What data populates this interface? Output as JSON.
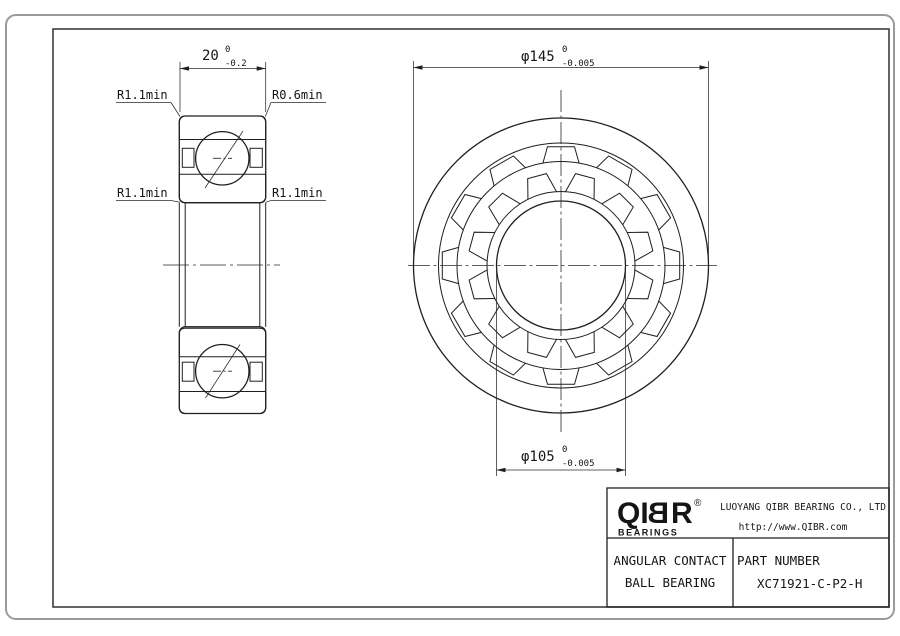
{
  "section_view": {
    "dim_width": {
      "value": "20",
      "tol_top": "0",
      "tol_bottom": "-0.2"
    },
    "labels": {
      "top_left": "R1.1min",
      "top_right": "R0.6min",
      "bottom_left": "R1.1min",
      "bottom_right": "R1.1min"
    }
  },
  "front_view": {
    "dim_outer": {
      "value": "φ145",
      "tol_top": "0",
      "tol_bottom": "-0.005"
    },
    "dim_bore": {
      "value": "φ105",
      "tol_top": "0",
      "tol_bottom": "-0.005"
    }
  },
  "title_block": {
    "logo": {
      "qi": "QI",
      "b": "B",
      "r": "R",
      "reg": "®",
      "sub": "BEARINGS"
    },
    "company": "LUOYANG QIBR BEARING CO., LTD",
    "website": "http://www.QIBR.com",
    "product_line1": "ANGULAR CONTACT",
    "product_line2": "BALL BEARING",
    "part_label": "PART NUMBER",
    "part_number": "XC71921-C-P2-H"
  },
  "colors": {
    "line": "#1f1f1f",
    "frame": "#3c3c3c",
    "outer_border": "#9a9a9a",
    "bg": "#ffffff"
  }
}
